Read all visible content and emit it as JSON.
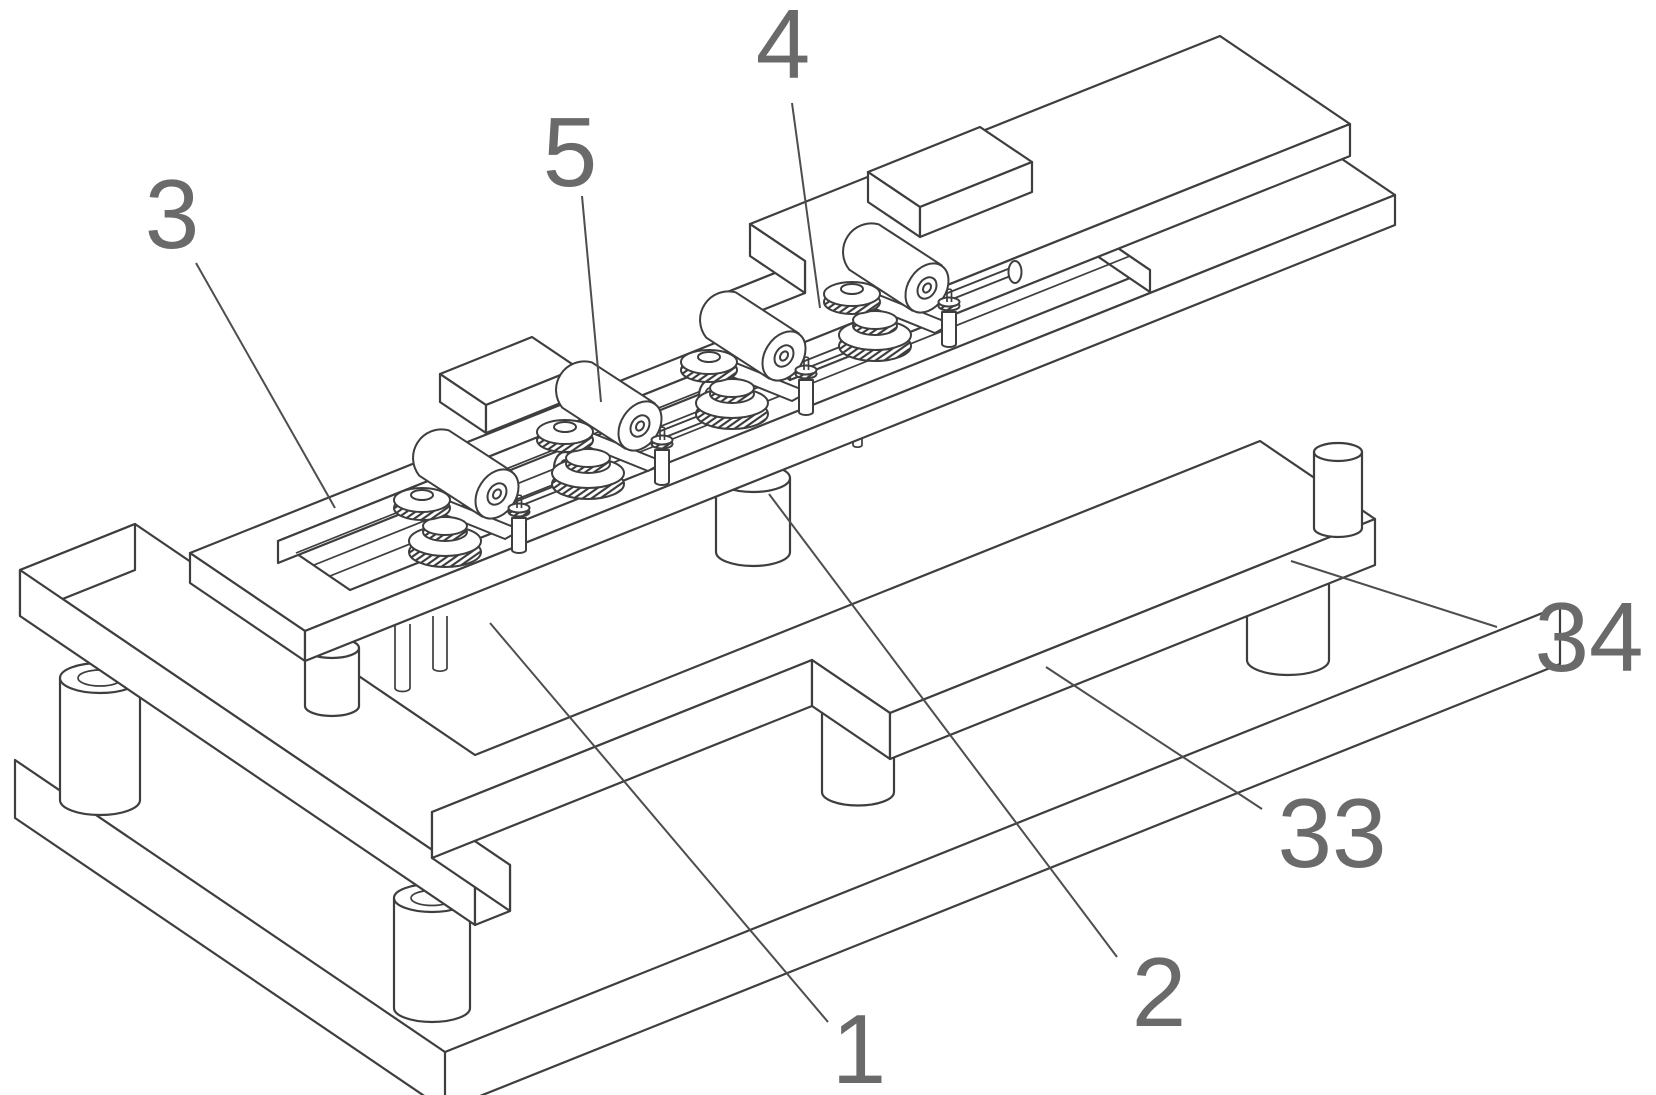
{
  "figure": {
    "type": "patent-isometric-line-drawing",
    "background": "#ffffff",
    "line_color": "#3e3e3e",
    "leader_color": "#4e4e4e",
    "label_color": "#6a6a6a",
    "labels": [
      {
        "text": "3",
        "x": 172,
        "y": 214,
        "leader": [
          196,
          263,
          335,
          508
        ],
        "target": "rail-plate"
      },
      {
        "text": "5",
        "x": 570,
        "y": 152,
        "leader": [
          582,
          196,
          601,
          402
        ],
        "target": "motor-unit"
      },
      {
        "text": "4",
        "x": 783,
        "y": 44,
        "leader": [
          792,
          103,
          820,
          308
        ],
        "target": "top-cover-plate"
      },
      {
        "text": "1",
        "x": 859,
        "y": 1049,
        "leader": [
          490,
          623,
          828,
          1022
        ],
        "target": "base-plate"
      },
      {
        "text": "2",
        "x": 1159,
        "y": 992,
        "leader": [
          769,
          494,
          1117,
          957
        ],
        "target": "support-pillar"
      },
      {
        "text": "33",
        "x": 1332,
        "y": 833,
        "leader": [
          1046,
          667,
          1262,
          809
        ],
        "target": "base-surface"
      },
      {
        "text": "34",
        "x": 1589,
        "y": 637,
        "leader": [
          1291,
          561,
          1497,
          627
        ],
        "target": "support-leg"
      }
    ]
  }
}
